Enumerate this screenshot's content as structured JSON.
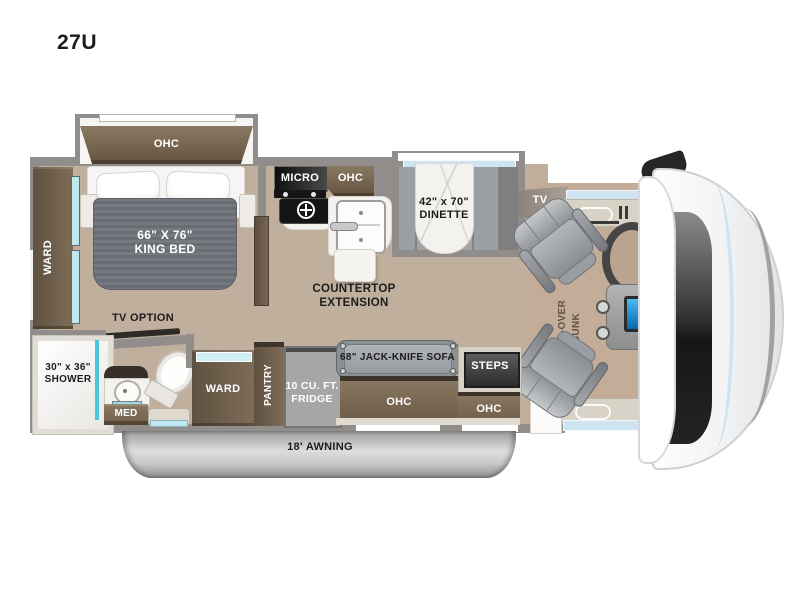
{
  "title": "27U",
  "colors": {
    "wood_floor": "#c0af9d",
    "cabinet_brown": "#7b6a56",
    "wall_gray": "#908d8a",
    "glass_blue": "#cfe4f2",
    "mirror_cyan": "#49c6da",
    "awning_silver": "#c6c7c9"
  },
  "plan": {
    "bedroom": {
      "ohc": "OHC",
      "bed_size": "66\" X 76\"",
      "bed_type": "KING BED",
      "ward": "WARD",
      "tv_option": "TV OPTION"
    },
    "bath": {
      "shower_size": "30\" x 36\"",
      "shower": "SHOWER",
      "med": "MED"
    },
    "kitchen": {
      "micro": "MICRO",
      "ohc": "OHC",
      "counter_line1": "COUNTERTOP",
      "counter_line2": "EXTENSION"
    },
    "dinette": {
      "size": "42\" x 70\"",
      "name": "DINETTE"
    },
    "living": {
      "tv": "TV",
      "sofa": "68\" JACK-KNIFE SOFA",
      "sofa_ohc": "OHC",
      "steps": "STEPS",
      "steps_ohc": "OHC",
      "ward": "WARD",
      "pantry": "PANTRY",
      "fridge_line1": "10 CU. FT.",
      "fridge_line2": "FRIDGE"
    },
    "cab": {
      "bunk_line1": "CAB-OVER",
      "bunk_line2": "BUNK"
    },
    "exterior": {
      "awning": "18' AWNING"
    }
  }
}
